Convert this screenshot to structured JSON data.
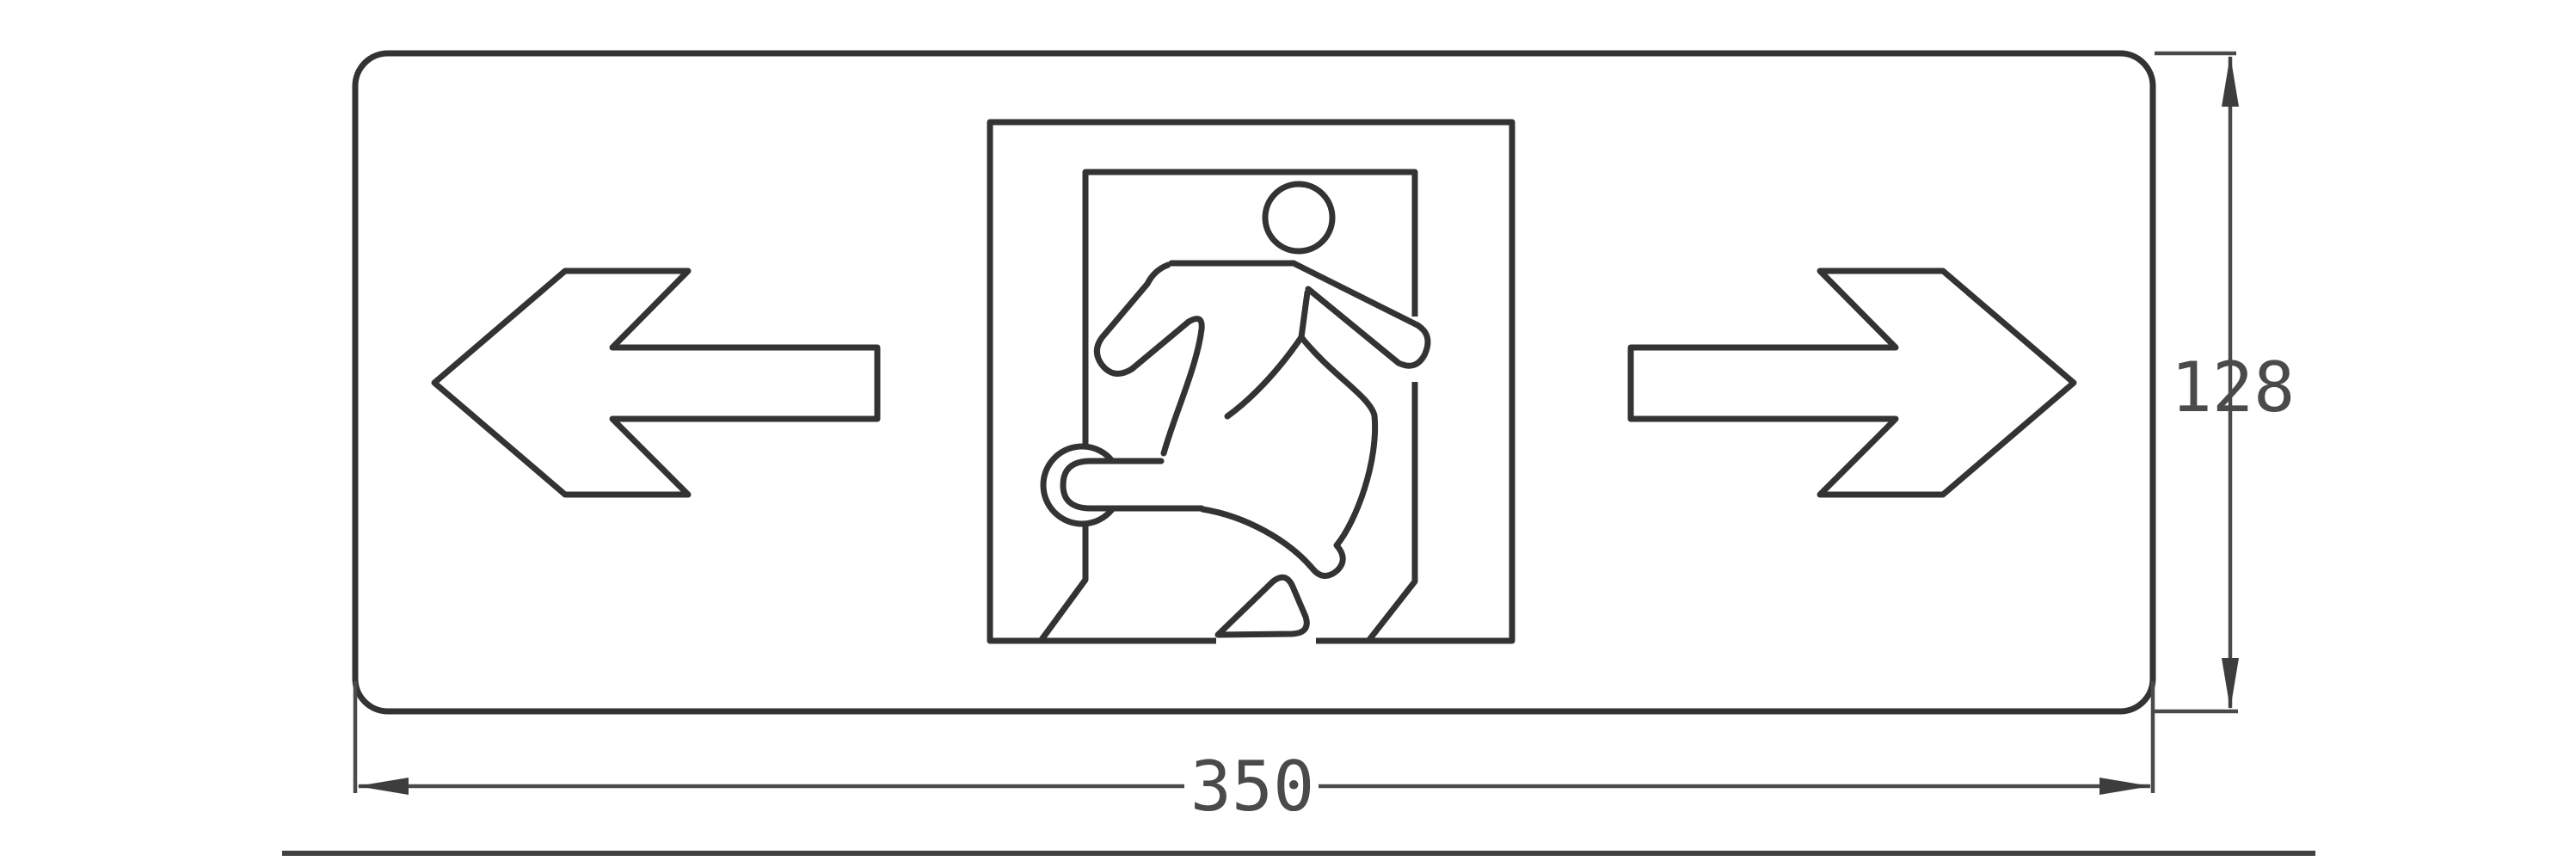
{
  "page": {
    "background": "#ffffff"
  },
  "drawing": {
    "type": "dimensioned technical line drawing",
    "subject": "emergency exit sign face: left arrow, running-man doorway pictogram, right arrow",
    "colors": {
      "outline": "#333333",
      "dimension_lines": "#4a4a4a",
      "dimension_text": "#4a4a4a",
      "background": "#ffffff"
    },
    "panel": {
      "shape": "rounded-rectangle"
    },
    "icons": [
      {
        "name": "left-arrow-icon"
      },
      {
        "name": "exit-running-man-icon"
      },
      {
        "name": "right-arrow-icon"
      }
    ],
    "dimensions": {
      "width": {
        "label": "350"
      },
      "height": {
        "label": "128"
      }
    }
  }
}
